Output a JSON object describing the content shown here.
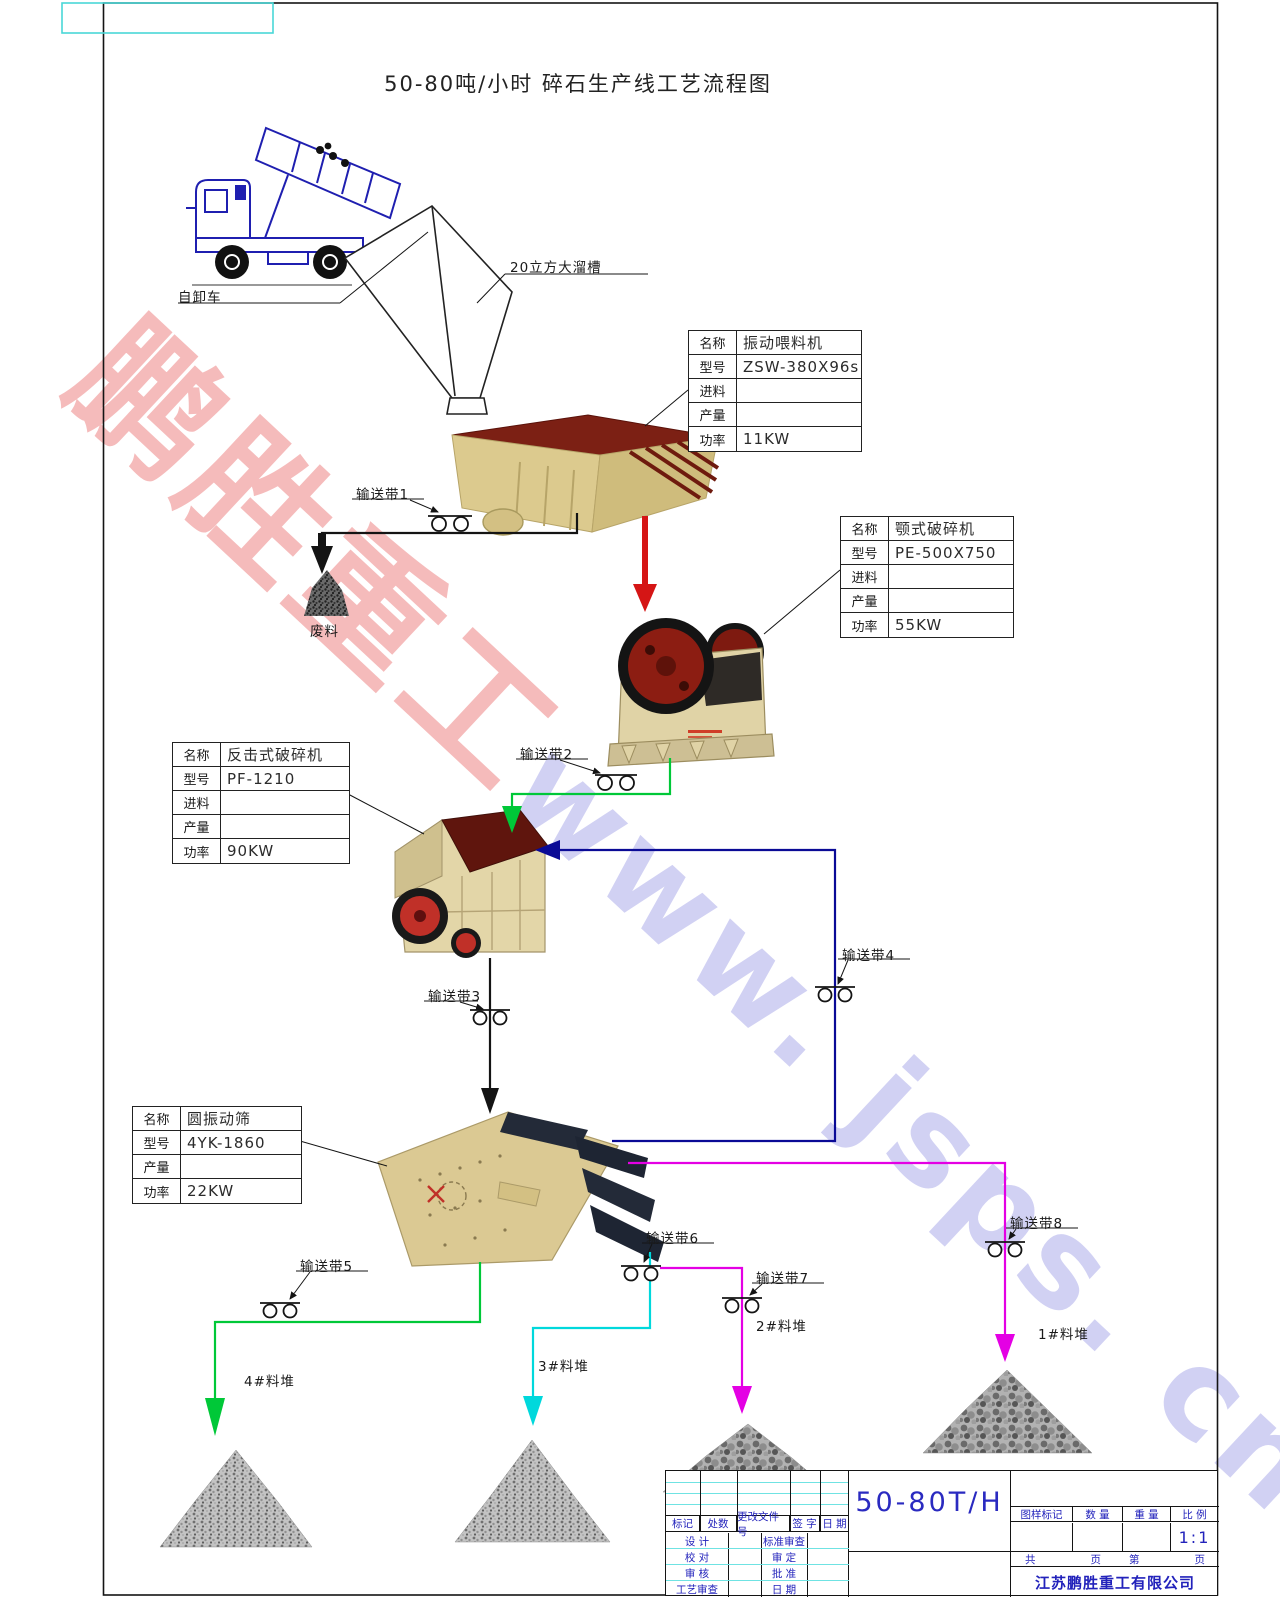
{
  "page": {
    "title": "50-80吨/小时  碎石生产线工艺流程图"
  },
  "watermark": {
    "cn": "鹏胜重工",
    "en": "www. jsps. cn"
  },
  "labels": {
    "truck": "自卸车",
    "hopper": "20立方大溜槽",
    "waste": "废料"
  },
  "conveyors": {
    "c1": "输送带1",
    "c2": "输送带2",
    "c3": "输送带3",
    "c4": "输送带4",
    "c5": "输送带5",
    "c6": "输送带6",
    "c7": "输送带7",
    "c8": "输送带8"
  },
  "piles": {
    "p1": "1#料堆",
    "p2": "2#料堆",
    "p3": "3#料堆",
    "p4": "4#料堆"
  },
  "spec_tables": {
    "feeder": {
      "rows": [
        {
          "label": "名称",
          "value": "振动喂料机"
        },
        {
          "label": "型号",
          "value": "ZSW-380X96s"
        },
        {
          "label": "进料",
          "value": ""
        },
        {
          "label": "产量",
          "value": ""
        },
        {
          "label": "功率",
          "value": "11KW"
        }
      ]
    },
    "jaw": {
      "rows": [
        {
          "label": "名称",
          "value": "颚式破碎机"
        },
        {
          "label": "型号",
          "value": "PE-500X750"
        },
        {
          "label": "进料",
          "value": ""
        },
        {
          "label": "产量",
          "value": ""
        },
        {
          "label": "功率",
          "value": "55KW"
        }
      ]
    },
    "impact": {
      "rows": [
        {
          "label": "名称",
          "value": "反击式破碎机"
        },
        {
          "label": "型号",
          "value": "PF-1210"
        },
        {
          "label": "进料",
          "value": ""
        },
        {
          "label": "产量",
          "value": ""
        },
        {
          "label": "功率",
          "value": "90KW"
        }
      ]
    },
    "screen": {
      "rows": [
        {
          "label": "名称",
          "value": "圆振动筛"
        },
        {
          "label": "型号",
          "value": "4YK-1860"
        },
        {
          "label": "产量",
          "value": ""
        },
        {
          "label": "功率",
          "value": "22KW"
        }
      ]
    }
  },
  "title_block": {
    "rev_header": [
      "标记",
      "处数",
      "更改文件号",
      "签 字",
      "日 期"
    ],
    "sign_rows": [
      [
        "设 计",
        "标准审查"
      ],
      [
        "校 对",
        "审 定"
      ],
      [
        "审 核",
        "批 准"
      ],
      [
        "工艺审查",
        "日 期"
      ]
    ],
    "drawing_title": "50-80T/H",
    "info_header": [
      "图样标记",
      "数 量",
      "重 量",
      "比 例"
    ],
    "scale": "1:1",
    "pages": {
      "total": "共",
      "total_pages": "页",
      "page": "第",
      "page_no": "页"
    },
    "company": "江苏鹏胜重工有限公司"
  },
  "colors": {
    "green": "#00c838",
    "cyan": "#00d8dc",
    "magenta": "#e400e4",
    "navy": "#0a0a96",
    "red": "#d51515",
    "ink": "#141414",
    "blue_text": "#2222bb",
    "grid_cyan": "#6fe3e3",
    "wm_red": "#ef8f8f",
    "wm_blue": "#b4b4ec"
  }
}
